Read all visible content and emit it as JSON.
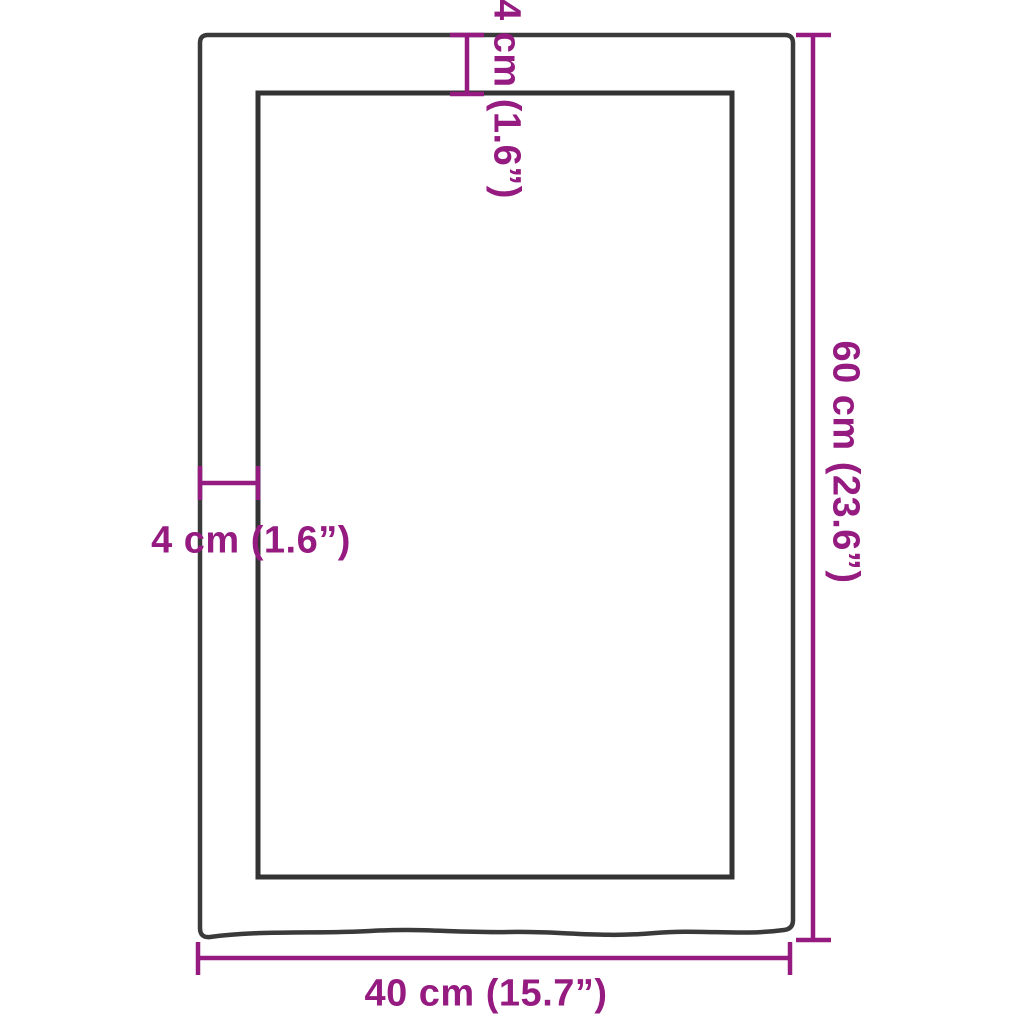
{
  "diagram": {
    "type": "product-dimension-diagram",
    "subject": "wall-shelf wooden panel with live (wavy) bottom edge, top view frame with inner recess",
    "labels": {
      "top_frame_thickness": "4 cm (1.6”)",
      "left_frame_thickness": "4 cm (1.6”)",
      "overall_height": "60 cm (23.6”)",
      "overall_width": "40 cm (15.7”)"
    },
    "measurements": [
      {
        "name": "frame-thickness-top",
        "value_cm": 4,
        "value_in": 1.6,
        "orientation": "vertical"
      },
      {
        "name": "frame-thickness-left",
        "value_cm": 4,
        "value_in": 1.6,
        "orientation": "horizontal"
      },
      {
        "name": "overall-height",
        "value_cm": 60,
        "value_in": 23.6,
        "orientation": "vertical"
      },
      {
        "name": "overall-width",
        "value_cm": 40,
        "value_in": 15.7,
        "orientation": "horizontal"
      }
    ]
  },
  "colors": {
    "dimension": "#951b81",
    "frame": "#3a3a3a",
    "background": "#ffffff"
  }
}
